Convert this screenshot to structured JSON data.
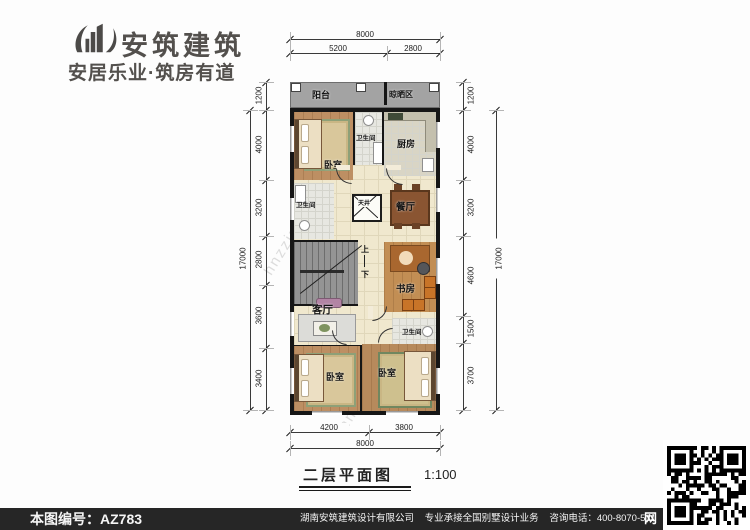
{
  "brand": {
    "name": "安筑建筑",
    "tagline": "安居乐业·筑房有道"
  },
  "watermark": {
    "text": "hnzzjz.com"
  },
  "plan": {
    "rooms": {
      "balcony": "阳台",
      "drying": "晾晒区",
      "bedroom_tl": "卧室",
      "bath_top": "卫生间",
      "kitchen": "厨房",
      "bath_mid": "卫生间",
      "lightwell": "天井",
      "dining": "餐厅",
      "study": "书房",
      "living": "客厅",
      "bath_low": "卫生间",
      "bedroom_bl": "卧室",
      "bedroom_br": "卧室"
    },
    "stairs": {
      "up": "上",
      "down": "下"
    },
    "dims": {
      "top_total": "8000",
      "top_left": "5200",
      "top_right": "2800",
      "bottom_left": "4200",
      "bottom_right": "3800",
      "bottom_total": "8000",
      "left": [
        "1200",
        "4000",
        "3200",
        "2800",
        "3600",
        "3400"
      ],
      "left_total": "17000",
      "right": [
        "1200",
        "4000",
        "3200",
        "4600",
        "1500",
        "3700"
      ],
      "right_total": "17000"
    }
  },
  "title": {
    "text": "二层平面图",
    "scale": "1:100"
  },
  "footer": {
    "serial": "本图编号：AZ783",
    "company": "湖南安筑建筑设计有限公司",
    "service": "专业承接全国别墅设计业务",
    "phone": "咨询电话：400-8070-511",
    "web": "网"
  },
  "colors": {
    "wall": "#161616",
    "wood_floor": "#bd8f63",
    "cream_floor": "#f0e8ce",
    "tile_floor": "#e7e7e1",
    "balcony_gray": "#a3a3a3",
    "footer_bg": "#262626"
  }
}
